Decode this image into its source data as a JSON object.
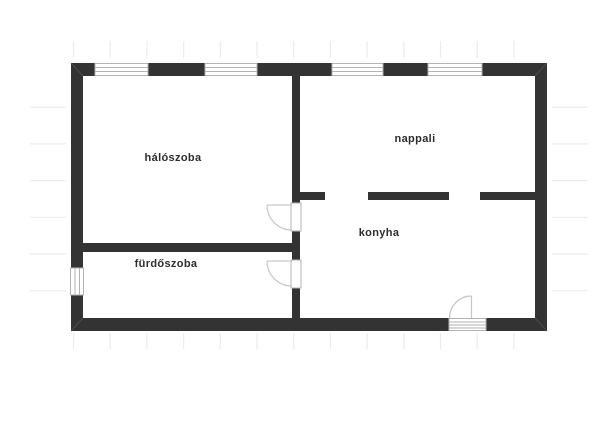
{
  "rooms": [
    {
      "name": "hálószoba"
    },
    {
      "name": "nappali"
    },
    {
      "name": "konyha"
    },
    {
      "name": "fürdőszoba"
    }
  ],
  "colors": {
    "background": "#ffffff",
    "wall": "#333333",
    "label_text": "#2d2d2d",
    "fixture_frame": "#b3b3b3",
    "door_swing": "#c6c6c6",
    "grid_tick": "#ececec"
  }
}
